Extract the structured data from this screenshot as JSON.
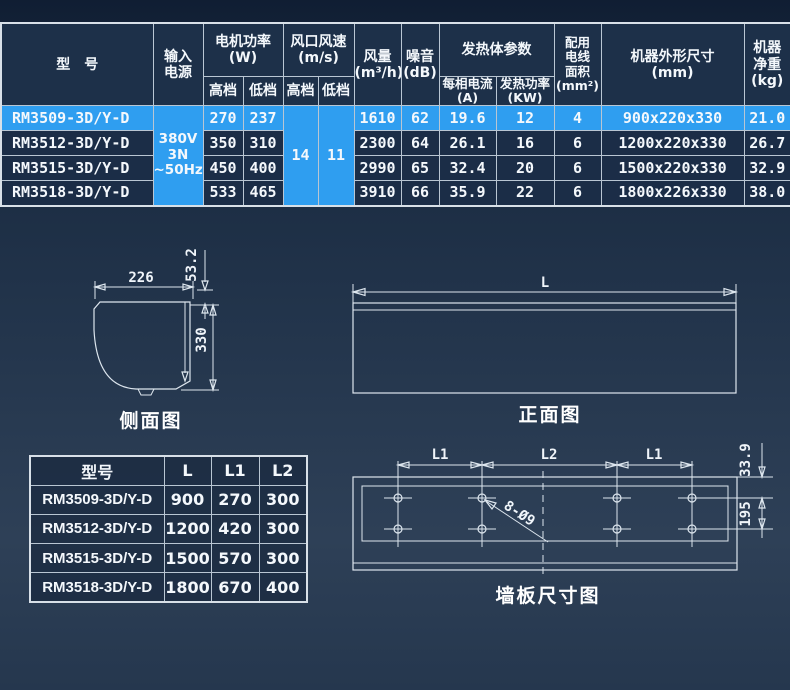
{
  "colors": {
    "highlight": "#2f9ef0",
    "table_cell": "#1b2d47",
    "grid_line": "#b9c6d3"
  },
  "spec_table": {
    "headers": {
      "model": "型　号",
      "input_power": "输入\n电源",
      "motor_power": "电机功率\n(W)",
      "outlet_speed": "风口风速\n(m/s)",
      "gear_high": "高档",
      "gear_low": "低档",
      "air_volume": "风量\n(m³/h)",
      "noise": "噪音\n(dB)",
      "heater": "发热体参数",
      "phase_current": "每相电流\n(A)",
      "heating_power": "发热功率\n(KW)",
      "wire_area": "配用\n电线\n面积\n(mm²)",
      "outline_size": "机器外形尺寸\n(mm)",
      "net_weight": "机器\n净重\n(kg)"
    },
    "merged_values": {
      "input_power": "380V\n3N\n~50Hz",
      "speed_high": "14",
      "speed_low": "11"
    },
    "rows": [
      {
        "model": "RM3509-3D/Y-D",
        "motor_high": "270",
        "motor_low": "237",
        "air_volume": "1610",
        "noise": "62",
        "phase_current": "19.6",
        "heating_power": "12",
        "wire_area": "4",
        "outline_size": "900x220x330",
        "net_weight": "21.0"
      },
      {
        "model": "RM3512-3D/Y-D",
        "motor_high": "350",
        "motor_low": "310",
        "air_volume": "2300",
        "noise": "64",
        "phase_current": "26.1",
        "heating_power": "16",
        "wire_area": "6",
        "outline_size": "1200x220x330",
        "net_weight": "26.7"
      },
      {
        "model": "RM3515-3D/Y-D",
        "motor_high": "450",
        "motor_low": "400",
        "air_volume": "2990",
        "noise": "65",
        "phase_current": "32.4",
        "heating_power": "20",
        "wire_area": "6",
        "outline_size": "1500x220x330",
        "net_weight": "32.9"
      },
      {
        "model": "RM3518-3D/Y-D",
        "motor_high": "533",
        "motor_low": "465",
        "air_volume": "3910",
        "noise": "66",
        "phase_current": "35.9",
        "heating_power": "22",
        "wire_area": "6",
        "outline_size": "1800x226x330",
        "net_weight": "38.0"
      }
    ]
  },
  "size_table": {
    "headers": [
      "型号",
      "L",
      "L1",
      "L2"
    ],
    "rows": [
      [
        "RM3509-3D/Y-D",
        "900",
        "270",
        "300"
      ],
      [
        "RM3512-3D/Y-D",
        "1200",
        "420",
        "300"
      ],
      [
        "RM3515-3D/Y-D",
        "1500",
        "570",
        "300"
      ],
      [
        "RM3518-3D/Y-D",
        "1800",
        "670",
        "400"
      ]
    ]
  },
  "side_view": {
    "caption": "侧面图",
    "width": "226",
    "depth": "53.2",
    "height": "330"
  },
  "front_view": {
    "caption": "正面图",
    "length": "L"
  },
  "wall_plate": {
    "caption": "墙板尺寸图",
    "left_span": "L1",
    "center_span": "L2",
    "right_span": "L1",
    "holes": "8-Ø9",
    "top_offset": "33.9",
    "hole_gap": "195"
  }
}
